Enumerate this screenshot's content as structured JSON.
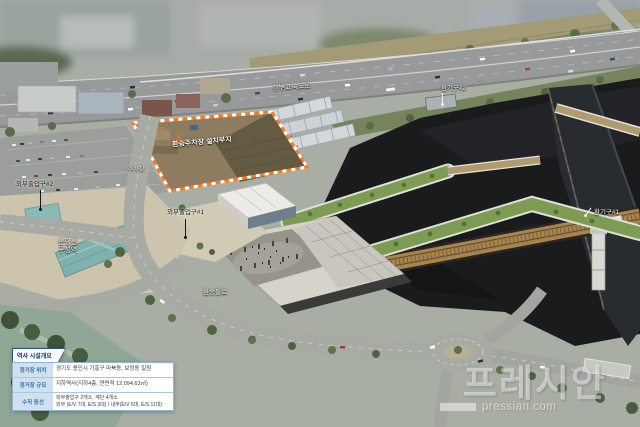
{
  "scene": {
    "description": "aerial-rendering-of-underground-station-site",
    "labels": {
      "highway": "경부고속도로",
      "vent_upper": "환기구#2",
      "site": "환승주차장 설치부지",
      "parking": "주차장",
      "entrance1": "외부출입구#1",
      "entrance2": "외부출입구#2",
      "bundang_line": "분당선",
      "guseong_station": "구성역",
      "transfer_passage": "환승통로",
      "vent_right": "환기구#1"
    }
  },
  "info_box": {
    "title": "역사 시설개요",
    "rows": [
      {
        "label": "정거장 위치",
        "value": "경기도 용인시 기흥구 마북동, 보정동 일원"
      },
      {
        "label": "정거장 규모",
        "value": "지하역사(지하4층, 연면적 12,094.63㎡)"
      },
      {
        "label": "수직 동선",
        "value_line1": "외부출입구 2개소, 계단 4개소",
        "value_line2": "외부 (E/V 7대, E/S 3대) / 내부(E/V 5대, E/S 11대)"
      }
    ]
  },
  "watermark": {
    "logo": "프레시안",
    "domain": "pressian.com"
  },
  "colors": {
    "site_outline_orange": "#ff7a1e",
    "infobox_header_text": "#13355c",
    "infobox_label_bg": "#cfe0ef",
    "infobox_label_text": "#3c72a4",
    "teal_roof": "#7fb2ae",
    "deck_green": "#7d9b53",
    "rail_tan": "#a8854f",
    "pit_dark": "#1a1b1d",
    "watermark_white": "rgba(250,250,252,0.5)"
  }
}
